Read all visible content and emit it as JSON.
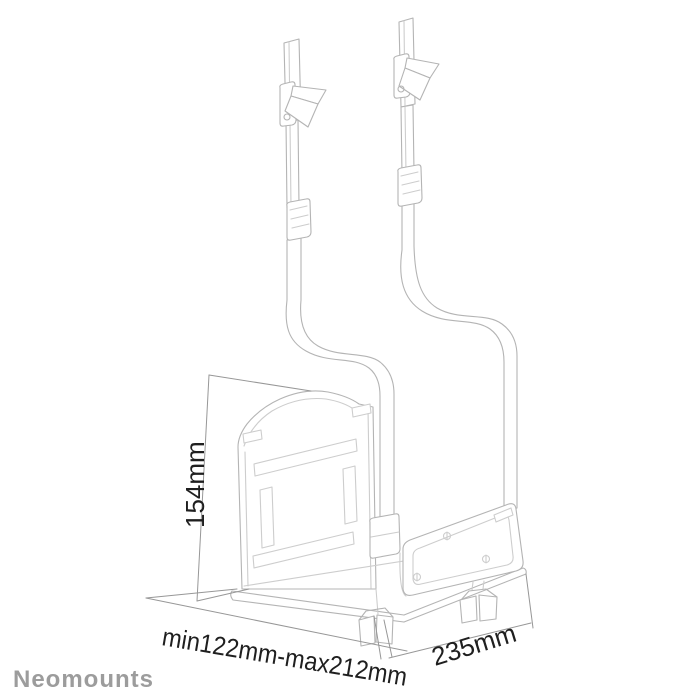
{
  "canvas": {
    "width": 700,
    "height": 700,
    "background": "#ffffff"
  },
  "drawing": {
    "kind": "technical-line-drawing",
    "subject": "under-desk CPU holder with two adjustable hook straps, side panel and wing-nut clamps",
    "line_color": "#b4b4b4",
    "light_line_color": "#cdcdcd",
    "dimension_line_color": "#979797"
  },
  "annotations": {
    "height_label": "154mm",
    "width_label": "min122mm-max212mm",
    "depth_label": "235mm",
    "text_color": "#1f1f1f"
  },
  "brand": {
    "name": "Neomounts",
    "color": "#9c9c9c"
  }
}
